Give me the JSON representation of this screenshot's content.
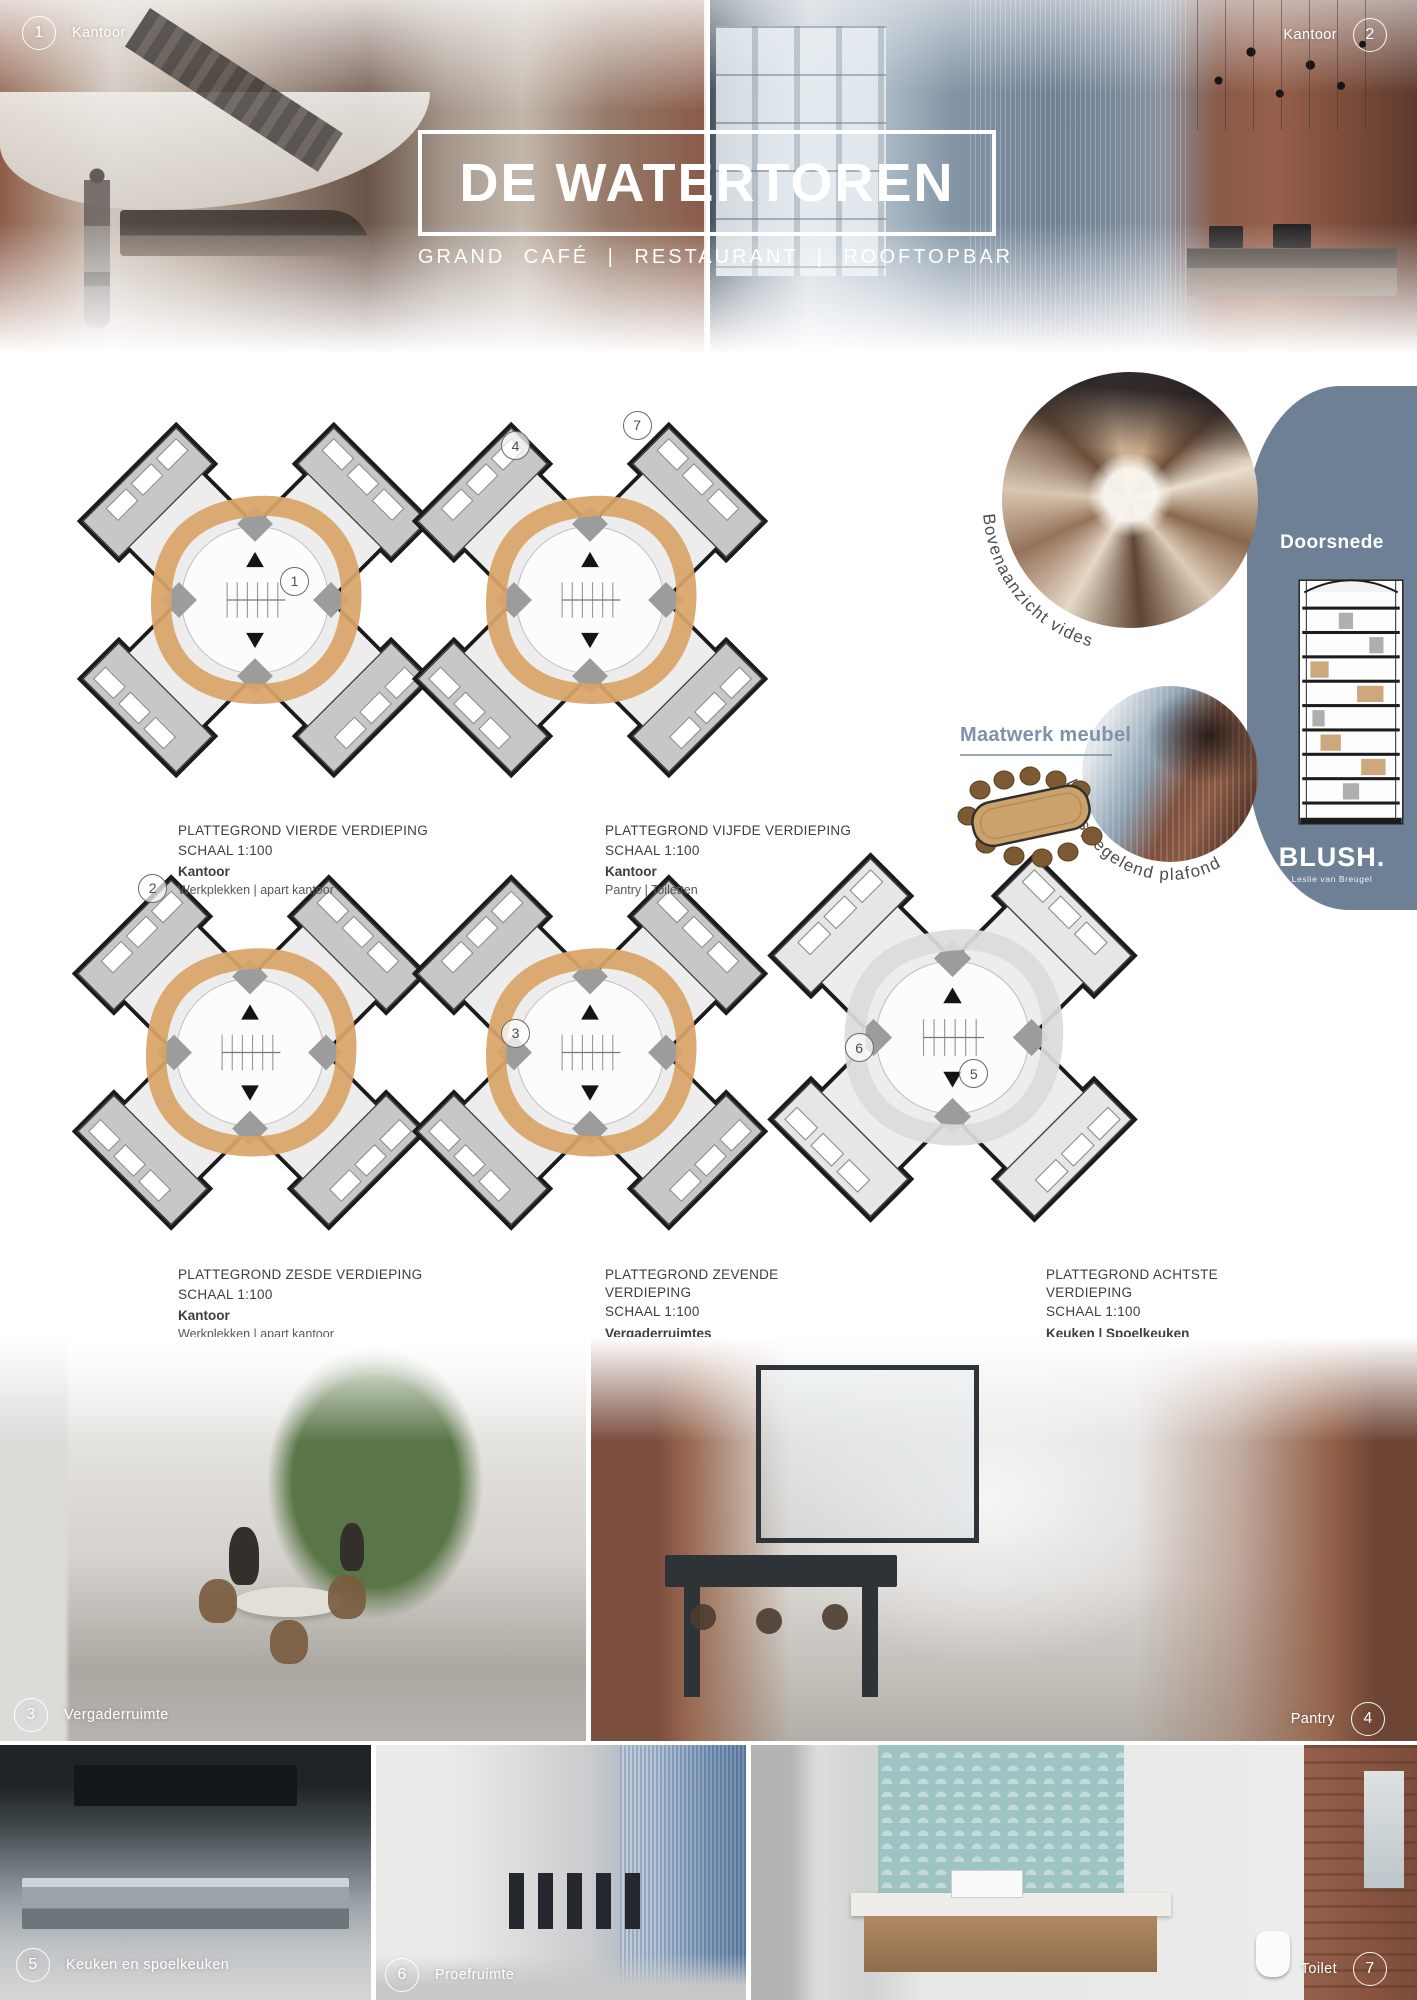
{
  "colors": {
    "accent_blue_gray": "#6d8096",
    "plan_ring_orange": "#d9a468",
    "label_blue": "#7e93aa",
    "caption_text": "#3e3e3e"
  },
  "header": {
    "title": "DE WATERTOREN",
    "subtitle": "GRAND CAFÉ | RESTAURANT | ROOFTOPBAR",
    "markers": {
      "left": {
        "number": "1",
        "label": "Kantoor"
      },
      "right": {
        "number": "2",
        "label": "Kantoor"
      }
    }
  },
  "plans": [
    {
      "title": "PLATTEGROND VIERDE VERDIEPING",
      "scale": "SCHAAL 1:100",
      "category": "Kantoor",
      "details": "Werkplekken | apart kantoor",
      "markers": [
        {
          "n": "1"
        }
      ]
    },
    {
      "title": "PLATTEGROND VIJFDE VERDIEPING",
      "scale": "SCHAAL 1:100",
      "category": "Kantoor",
      "details": "Pantry | Toiletten",
      "markers": [
        {
          "n": "4"
        },
        {
          "n": "7"
        }
      ]
    },
    {
      "title": "PLATTEGROND ZESDE VERDIEPING",
      "scale": "SCHAAL 1:100",
      "category": "Kantoor",
      "details": "Werkplekken | apart kantoor",
      "markers": [
        {
          "n": "2"
        }
      ]
    },
    {
      "title": "PLATTEGROND ZEVENDE VERDIEPING",
      "scale": "SCHAAL 1:100",
      "category": "Vergaderruimtes",
      "details": "",
      "markers": [
        {
          "n": "3"
        }
      ]
    },
    {
      "title": "PLATTEGROND ACHTSTE VERDIEPING",
      "scale": "SCHAAL 1:100",
      "category": "Keuken | Spoelkeuken",
      "details": "Proefruimte | Grote keuken",
      "markers": [
        {
          "n": "6"
        },
        {
          "n": "5"
        }
      ]
    }
  ],
  "side": {
    "top_circle_label": "Bovenaanzicht vides",
    "bottom_circle_label": "Weerspiegelend plafond",
    "furniture_label": "Maatwerk meubel",
    "section_label": "Doorsnede",
    "logo": "BLUSH.",
    "logo_sub": "Leslie van Breugel"
  },
  "photo_labels": {
    "meeting": {
      "number": "3",
      "label": "Vergaderruimte"
    },
    "pantry": {
      "number": "4",
      "label": "Pantry"
    },
    "kitchen": {
      "number": "5",
      "label": "Keuken en spoelkeuken"
    },
    "tasting": {
      "number": "6",
      "label": "Proefruimte"
    },
    "toilet": {
      "number": "7",
      "label": "Toilet"
    }
  }
}
